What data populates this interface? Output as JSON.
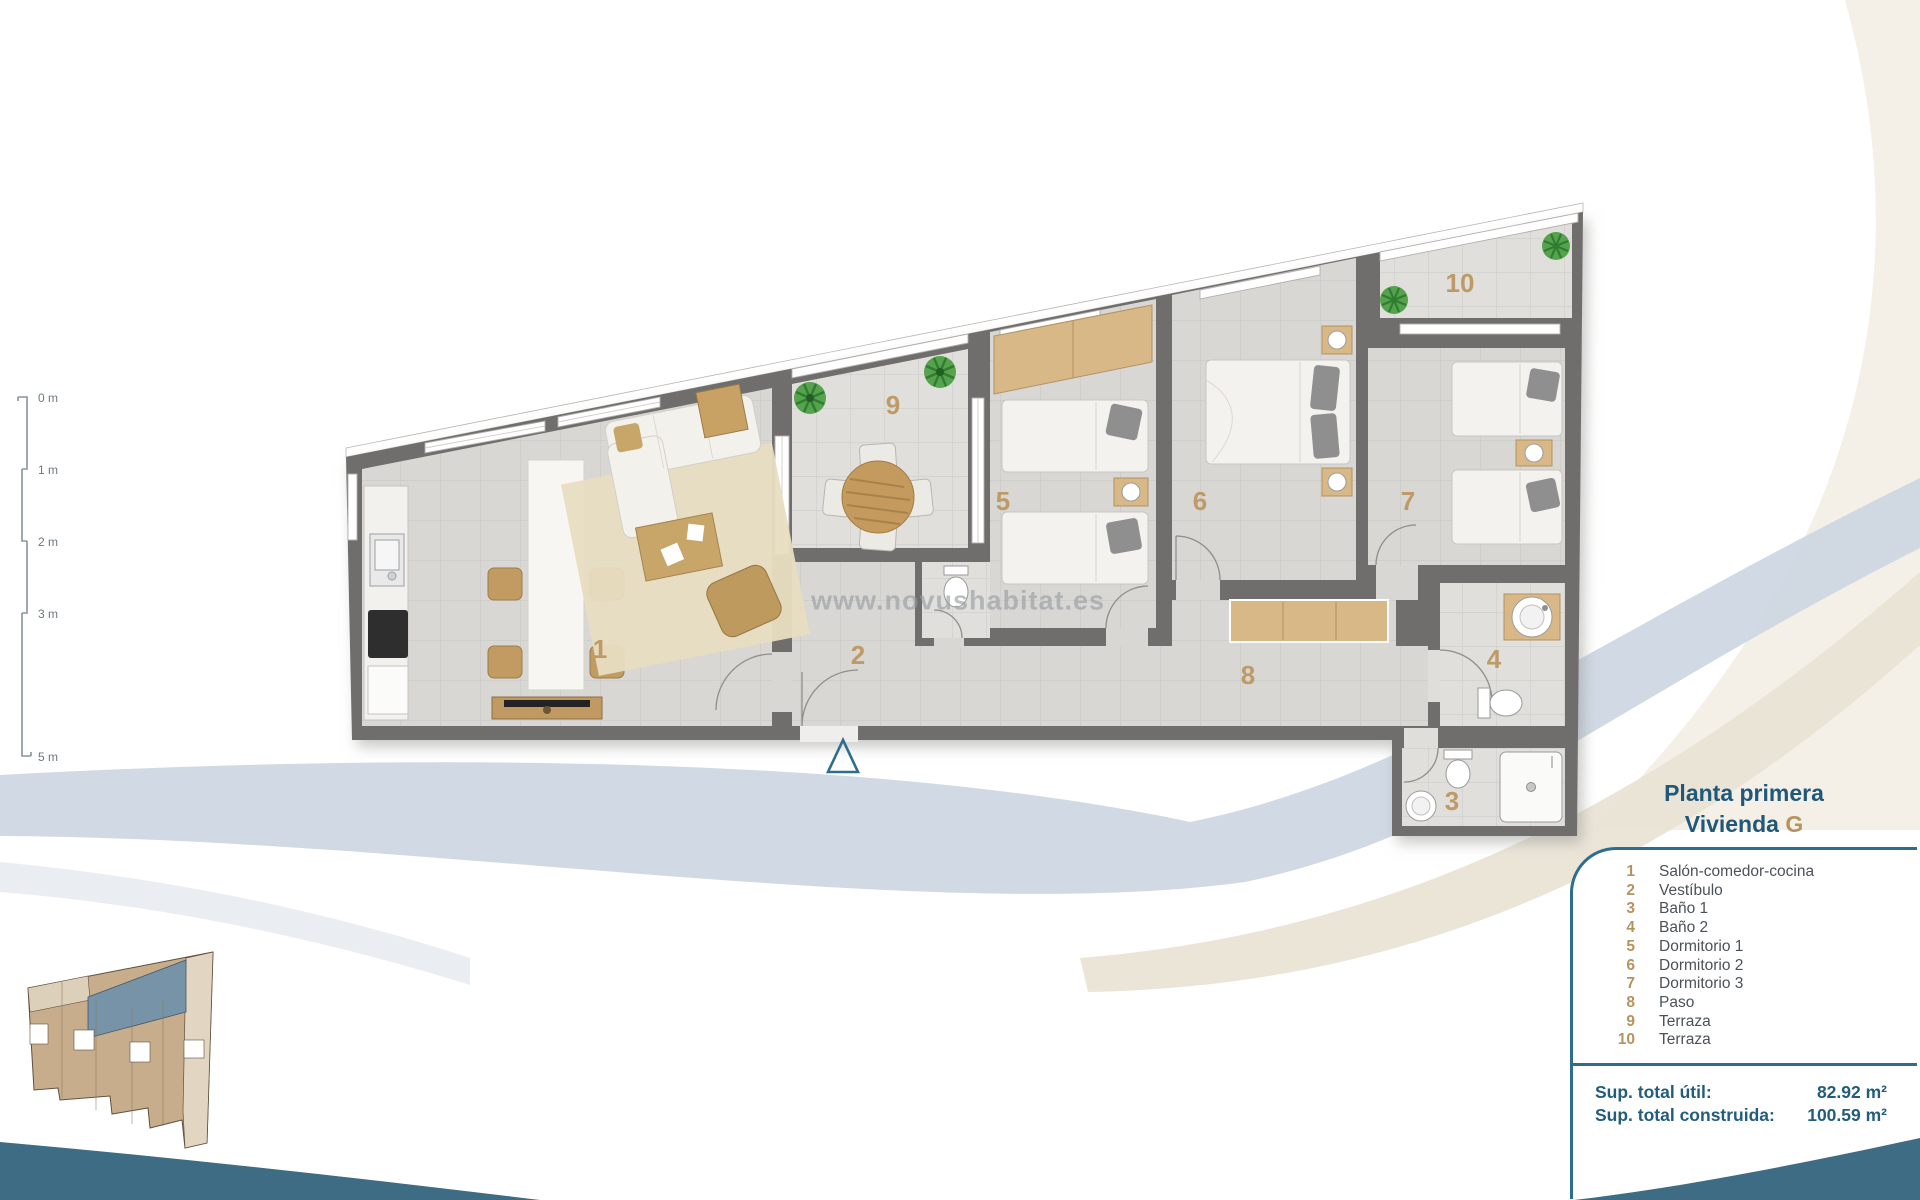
{
  "watermark": "www.novushabitat.es",
  "scale_bar": {
    "labels": [
      "0 m",
      "1 m",
      "2 m",
      "3 m",
      "5 m"
    ]
  },
  "plan": {
    "room_numbers": [
      {
        "num": "1"
      },
      {
        "num": "2"
      },
      {
        "num": "3"
      },
      {
        "num": "4"
      },
      {
        "num": "5"
      },
      {
        "num": "6"
      },
      {
        "num": "7"
      },
      {
        "num": "8"
      },
      {
        "num": "9"
      },
      {
        "num": "10"
      }
    ]
  },
  "legend": {
    "title_line1": "Planta primera",
    "title_line2_prefix": "Vivienda",
    "unit_letter": "G",
    "items": [
      {
        "num": "1",
        "label": "Salón-comedor-cocina"
      },
      {
        "num": "2",
        "label": "Vestíbulo"
      },
      {
        "num": "3",
        "label": "Baño 1"
      },
      {
        "num": "4",
        "label": "Baño 2"
      },
      {
        "num": "5",
        "label": "Dormitorio 1"
      },
      {
        "num": "6",
        "label": "Dormitorio 2"
      },
      {
        "num": "7",
        "label": "Dormitorio 3"
      },
      {
        "num": "8",
        "label": "Paso"
      },
      {
        "num": "9",
        "label": "Terraza"
      },
      {
        "num": "10",
        "label": "Terraza"
      }
    ],
    "totals": [
      {
        "label": "Sup. total útil:",
        "value": "82.92 m²"
      },
      {
        "label": "Sup. total construida:",
        "value": "100.59 m²"
      }
    ]
  },
  "colors": {
    "accent_teal": "#2d6e8e",
    "title_blue": "#1f5878",
    "number_tan": "#b5935f",
    "wave_teal": "#3d6c84",
    "wall_gray": "#6f6e6c",
    "band_blue": "#ccd6e2",
    "band_beige": "#e9e2d4"
  }
}
